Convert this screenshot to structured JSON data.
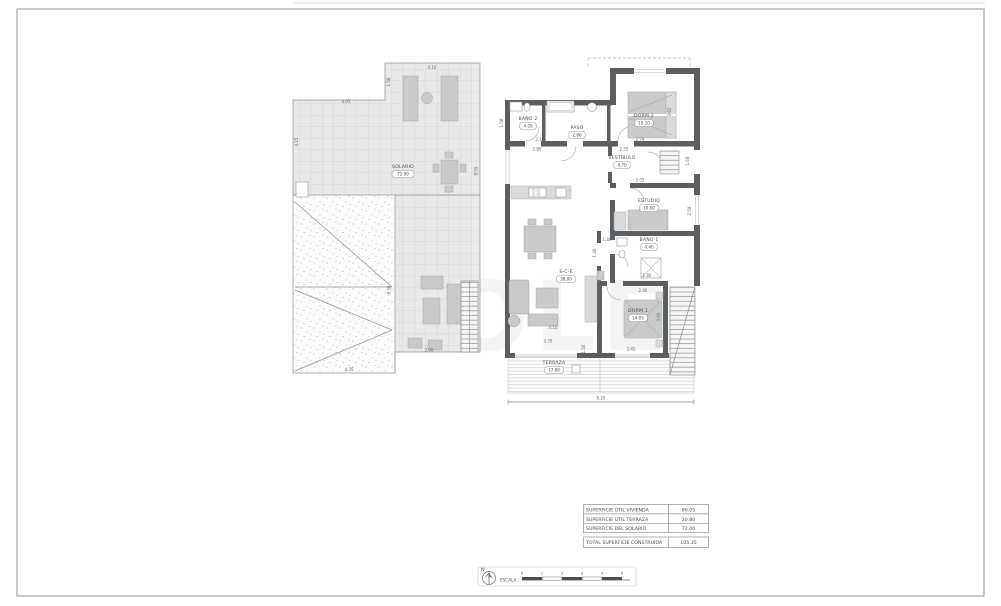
{
  "watermark": "OLE",
  "rooms": {
    "solario": {
      "label": "SOLARIO",
      "area": "72.00"
    },
    "bano2": {
      "label": "BAÑO 2",
      "area": "4.05"
    },
    "paso": {
      "label": "PASO",
      "area": "2.86"
    },
    "dorm2": {
      "label": "DORM.2",
      "area": "10.10"
    },
    "vestibulo": {
      "label": "VESTÍBULO",
      "area": "4.70"
    },
    "estudio": {
      "label": "ESTUDIO",
      "area": "10.00"
    },
    "bano1": {
      "label": "BAÑO 1",
      "area": "4.40"
    },
    "dorm1": {
      "label": "DORM.1",
      "area": "14.05"
    },
    "sce": {
      "label": "S-C-E",
      "area": "38.00"
    },
    "terraza": {
      "label": "TERRAZA",
      "area": "17.80"
    }
  },
  "dims": {
    "solario_top": "4.10",
    "solario_left_top": "4.05",
    "solario_notch": "1.58",
    "solario_left": "4.15",
    "solario_right": "8.55",
    "roof_right": "8.30",
    "roof_bottom": "4.35",
    "terrace_bottom": "3.90",
    "bano2_width": "2.10",
    "bano2_width2": "2.80",
    "dorm2_width": "2.79",
    "hall_width": "2.55",
    "dorm2_depth": "3.62",
    "vest_side": "1.68",
    "estudio_top": "3.05",
    "estudio_right": "2.59",
    "bano1_left": "1.46",
    "bano1_side": "1.40",
    "bano1_width": "1.80",
    "dorm1_top": "2.00",
    "dorm1_right": "3.60",
    "dorm1_bottom": "3.45",
    "sce_width": "4.10",
    "sce_bottom": "3.70",
    "terraza_side": "1.50",
    "overall_bottom": "8.20",
    "sce_left": "1.58"
  },
  "summary": {
    "rows": [
      {
        "label": "SUPERFICIE ÚTIL VIVIENDA",
        "value": "90.05"
      },
      {
        "label": "SUPERFICIE ÚTIL TERRAZA",
        "value": "20.80"
      },
      {
        "label": "SUPERFICIE DEL SOLARIO",
        "value": "72.00"
      }
    ],
    "total": {
      "label": "TOTAL SUPERFICIE CONSTRUIDA",
      "value": "105.35"
    }
  },
  "scalebar": {
    "north_label": "N",
    "escala_label": "ESCALA :",
    "ticks": [
      "0",
      "1",
      "2",
      "3",
      "4",
      "5"
    ]
  }
}
